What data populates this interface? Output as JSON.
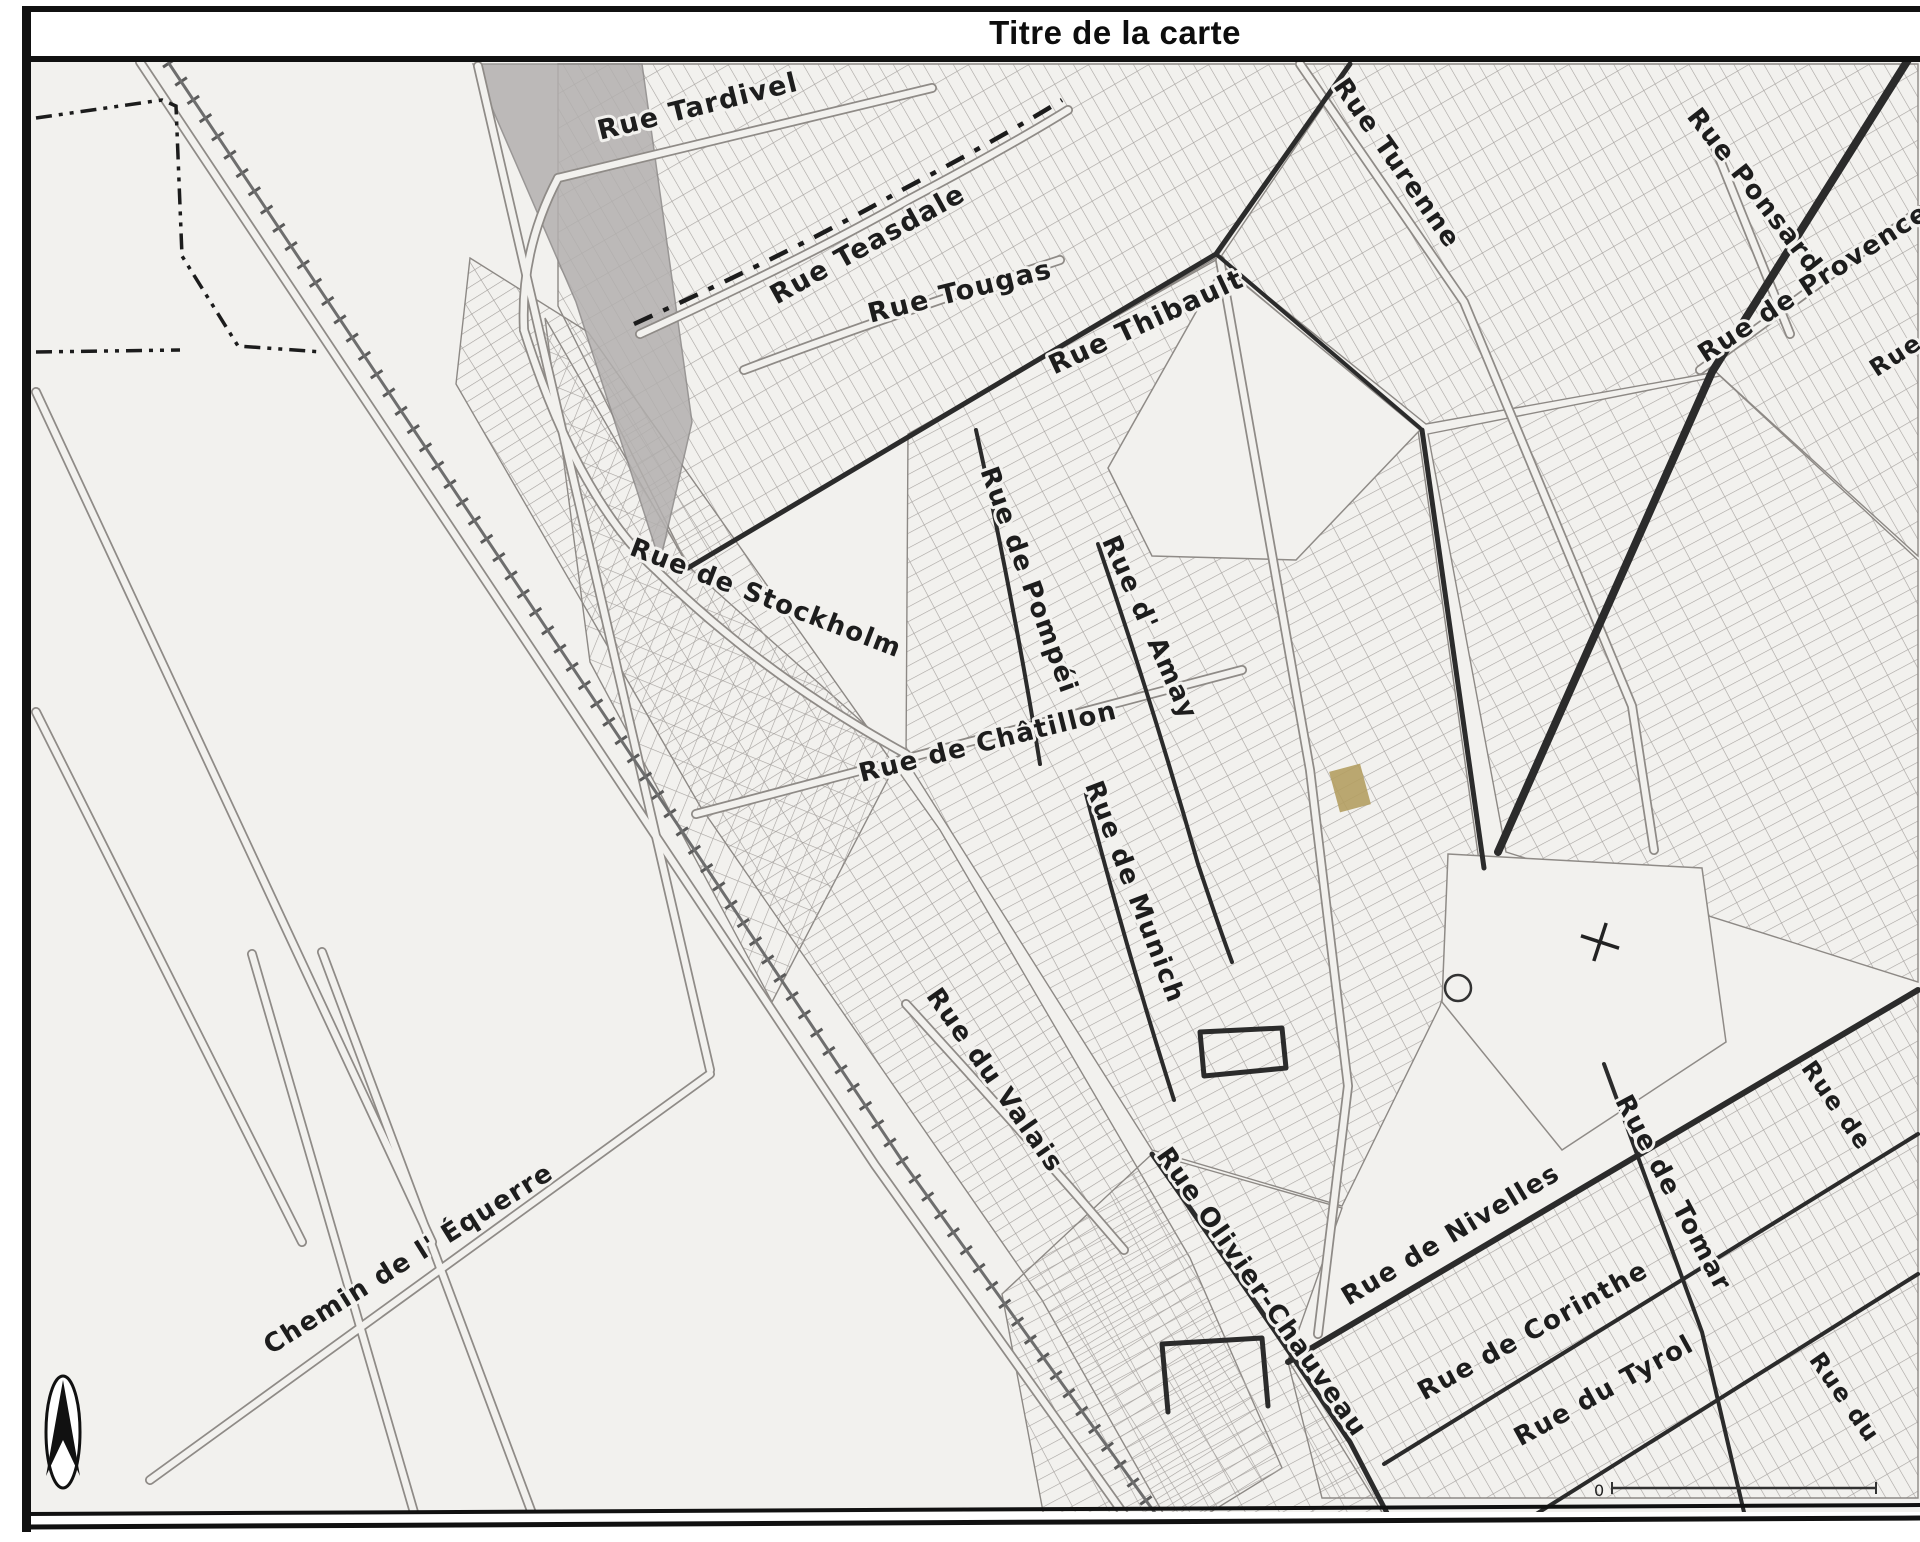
{
  "title": "Titre de la carte",
  "map": {
    "street_labels": [
      {
        "text": "Rue Tardivel",
        "x": 700,
        "y": 115,
        "angle": -14,
        "size": 27
      },
      {
        "text": "Rue Teasdale",
        "x": 872,
        "y": 252,
        "angle": -29,
        "size": 27
      },
      {
        "text": "Rue Tougas",
        "x": 962,
        "y": 300,
        "angle": -14,
        "size": 27
      },
      {
        "text": "Rue Thibault",
        "x": 1150,
        "y": 330,
        "angle": -25,
        "size": 27
      },
      {
        "text": "Rue Turenne",
        "x": 1390,
        "y": 168,
        "angle": 55,
        "size": 26
      },
      {
        "text": "Rue Ponsard",
        "x": 1748,
        "y": 196,
        "angle": 52,
        "size": 26
      },
      {
        "text": "Rue de Provence",
        "x": 1818,
        "y": 290,
        "angle": -33,
        "size": 26
      },
      {
        "text": "Rue de Stockholm",
        "x": 763,
        "y": 606,
        "angle": 21,
        "size": 26
      },
      {
        "text": "Rue de Pompéi",
        "x": 1021,
        "y": 583,
        "angle": 70,
        "size": 26
      },
      {
        "text": "Rue d' Amay",
        "x": 1142,
        "y": 631,
        "angle": 66,
        "size": 26
      },
      {
        "text": "Rue de Châtillon",
        "x": 990,
        "y": 750,
        "angle": -14,
        "size": 26
      },
      {
        "text": "Rue de Munich",
        "x": 1127,
        "y": 895,
        "angle": 69,
        "size": 26
      },
      {
        "text": "Rue du Valais",
        "x": 988,
        "y": 1085,
        "angle": 55,
        "size": 26
      },
      {
        "text": "Rue Olivier-Chauveau",
        "x": 1255,
        "y": 1297,
        "angle": 55,
        "size": 26
      },
      {
        "text": "Rue de Nivelles",
        "x": 1455,
        "y": 1242,
        "angle": -31,
        "size": 26
      },
      {
        "text": "Rue de Tomar",
        "x": 1666,
        "y": 1197,
        "angle": 62,
        "size": 26
      },
      {
        "text": "Rue de Corinthe",
        "x": 1537,
        "y": 1338,
        "angle": -29,
        "size": 26
      },
      {
        "text": "Rue du Tyrol",
        "x": 1608,
        "y": 1398,
        "angle": -29,
        "size": 26
      },
      {
        "text": "Chemin de l' Équerre",
        "x": 413,
        "y": 1266,
        "angle": -32,
        "size": 26
      },
      {
        "text": "Rue",
        "x": 1900,
        "y": 362,
        "angle": -33,
        "size": 24
      },
      {
        "text": "Rue de",
        "x": 1830,
        "y": 1110,
        "angle": 55,
        "size": 24
      },
      {
        "text": "Rue du",
        "x": 1838,
        "y": 1402,
        "angle": 55,
        "size": 24
      }
    ],
    "scale_bar": {
      "zero_label": "0"
    },
    "compass": "north-arrow",
    "colors": {
      "highlight_parcel": "#b49f62",
      "ink": "#2b2b2b",
      "road_gray": "#8f8b87",
      "shade_gray": "#b3b0af",
      "paper": "#f2f1ee"
    }
  }
}
